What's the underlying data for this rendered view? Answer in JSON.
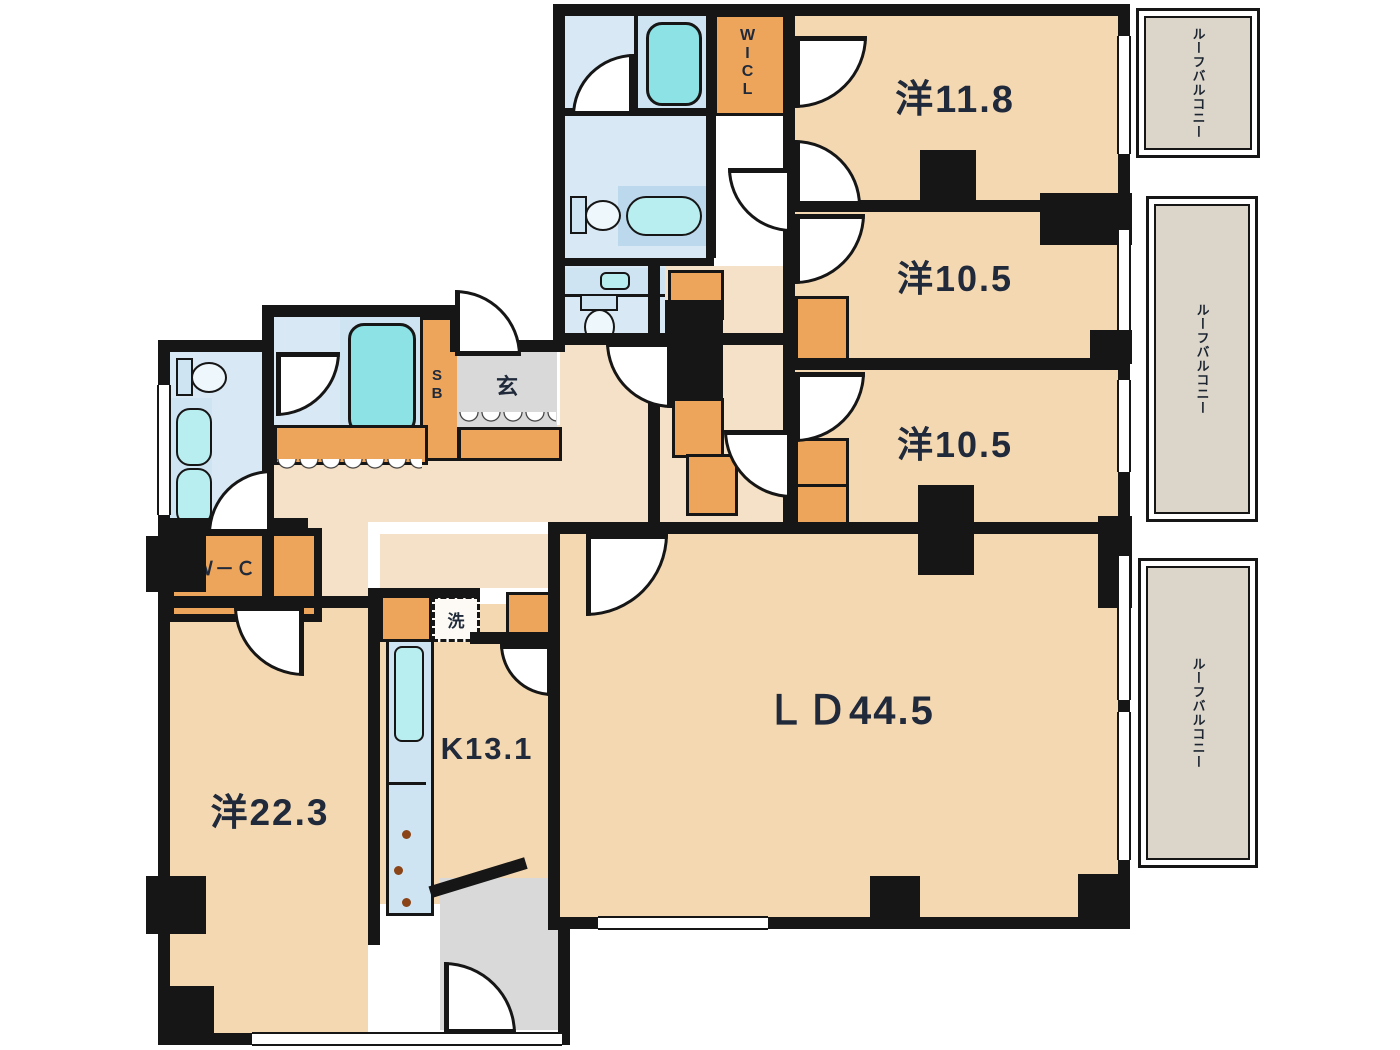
{
  "plan_title": "apartment-floor-plan",
  "rooms": [
    {
      "id": "bedroom-northeast",
      "label": "洋11.8"
    },
    {
      "id": "bedroom-east-upper",
      "label": "洋10.5"
    },
    {
      "id": "bedroom-east-lower",
      "label": "洋10.5"
    },
    {
      "id": "living-dining",
      "label": "ＬＤ44.5"
    },
    {
      "id": "kitchen",
      "label": "K13.1"
    },
    {
      "id": "bedroom-west",
      "label": "洋22.3"
    }
  ],
  "closets": {
    "walk_in_closet_vertical": "WICL",
    "walk_in_closet_west": "Ｗ－ＣＬ",
    "shoe_box": "SB"
  },
  "entrance_label": "玄",
  "laundry_label": "洗",
  "balconies": [
    {
      "label": "ルーフバルコニー"
    },
    {
      "label": "ルーフバルコニー"
    },
    {
      "label": "ルーフバルコニー"
    }
  ],
  "colors": {
    "wall": "#161616",
    "room_fill": "#f4d8b2",
    "hall_fill": "#f5e1c7",
    "closet_orange": "#eda55c",
    "wet_area_blue": "#d8e8f4",
    "bathtub_teal": "#8ce2e4",
    "entrance_gray": "#d9d9d9",
    "balcony_gray": "#dbd5ca",
    "label_text": "#202a3a"
  }
}
